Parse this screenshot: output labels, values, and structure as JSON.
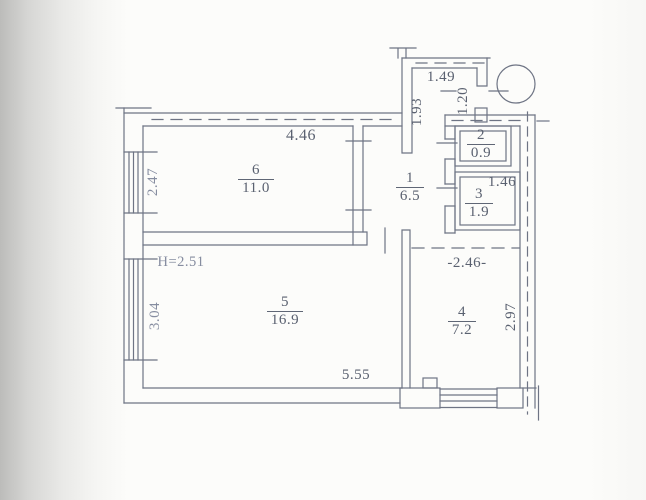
{
  "document": {
    "type": "scanned apartment floor plan (technical inventory drawing)"
  },
  "colors": {
    "ink": "#5a6170",
    "wall_line": "#6e7484",
    "paper": "#fcfcfa"
  },
  "rooms": [
    {
      "number": "6",
      "area": "11.0"
    },
    {
      "number": "1",
      "area": "6.5"
    },
    {
      "number": "2",
      "area": "0.9"
    },
    {
      "number": "3",
      "area": "1.9"
    },
    {
      "number": "5",
      "area": "16.9"
    },
    {
      "number": "4",
      "area": "7.2"
    }
  ],
  "dimensions": {
    "room6_width": "4.46",
    "vestibule_width": "1.49",
    "vestibule_depth": "1.93",
    "entry_niche": "1.20",
    "room6_window": "2.47",
    "room3_width": "1.46",
    "height_note": "H=2.51",
    "room5_window": "3.04",
    "room5_width": "5.55",
    "room4_opening": "-2.46-",
    "room4_depth": "2.97"
  }
}
